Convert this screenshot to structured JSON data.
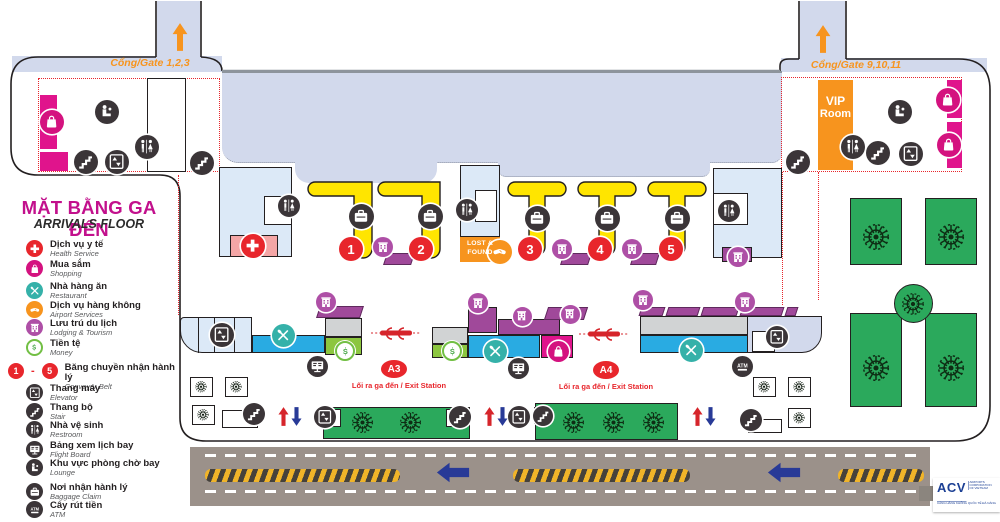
{
  "title": {
    "vi": "MẶT BẰNG GA ĐẾN",
    "en": "ARRIVALS FLOOR"
  },
  "gates": {
    "left": "Cổng/Gate 1,2,3",
    "right": "Cổng/Gate 9,10,11"
  },
  "vip": [
    "VIP",
    "Room"
  ],
  "lost_found": [
    "LOST &",
    "FOUND"
  ],
  "belts": [
    "1",
    "2",
    "3",
    "4",
    "5"
  ],
  "legend_range": {
    "from": "1",
    "sep": "-",
    "to": "5"
  },
  "exits": [
    {
      "code": "A3",
      "label": "Lối ra ga đến / Exit Station"
    },
    {
      "code": "A4",
      "label": "Lối ra ga đến / Exit Station"
    }
  ],
  "legend": [
    {
      "icon": "cross",
      "style": "ic-red",
      "vi": "Dịch vụ y tế",
      "en": "Health Service"
    },
    {
      "icon": "bag",
      "style": "ic-magenta",
      "vi": "Mua sắm",
      "en": "Shopping"
    },
    {
      "icon": "utensils",
      "style": "ic-teal",
      "vi": "Nhà hàng ăn",
      "en": "Restaurant"
    },
    {
      "icon": "handshake",
      "style": "ic-orange",
      "vi": "Dịch vụ hàng không",
      "en": "Airport Services"
    },
    {
      "icon": "building",
      "style": "ic-purple",
      "vi": "Lưu trú du lịch",
      "en": "Lodging & Tourism"
    },
    {
      "icon": "money",
      "style": "ic-money",
      "vi": "Tiền tệ",
      "en": "Money"
    },
    {
      "icon": "range",
      "style": "",
      "vi": "Băng chuyền nhận hành lý",
      "en": "Conveyor Belt"
    },
    {
      "icon": "elevator",
      "style": "ic-dark",
      "vi": "Thang máy",
      "en": "Elevator"
    },
    {
      "icon": "stairs",
      "style": "ic-dark",
      "vi": "Thang bộ",
      "en": "Stair"
    },
    {
      "icon": "restroom",
      "style": "ic-dark",
      "vi": "Nhà vệ sinh",
      "en": "Restroom"
    },
    {
      "icon": "flightboard",
      "style": "ic-dark",
      "vi": "Bảng xem lịch bay",
      "en": "Flight Board"
    },
    {
      "icon": "lounge",
      "style": "ic-dark",
      "vi": "Khu vực phòng chờ bay",
      "en": "Lounge"
    },
    {
      "icon": "baggage",
      "style": "ic-dark",
      "vi": "Nơi nhận hành lý",
      "en": "Baggage Claim"
    },
    {
      "icon": "atm",
      "style": "ic-dark",
      "vi": "Cây rút tiền",
      "en": "ATM"
    }
  ],
  "logo": {
    "name": "ACV",
    "tagline": "AIRPORTS CORPORATION OF VIETNAM",
    "subtitle": "CẢNG HÀNG KHÔNG QUỐC TẾ ĐÀ NẴNG"
  },
  "colors": {
    "belt_yellow": "#FFE500",
    "accent_red": "#E8262C",
    "orange": "#F7941E",
    "lavender": "#D2D9EC",
    "cyan": "#29ABE2",
    "green_garden": "#2BA95C",
    "green_money": "#8CC63F",
    "magenta": "#D4127F",
    "purple": "#A0499A",
    "navy": "#1B3F94",
    "road_gray": "#9B918A",
    "title_pink": "#C2108C"
  }
}
